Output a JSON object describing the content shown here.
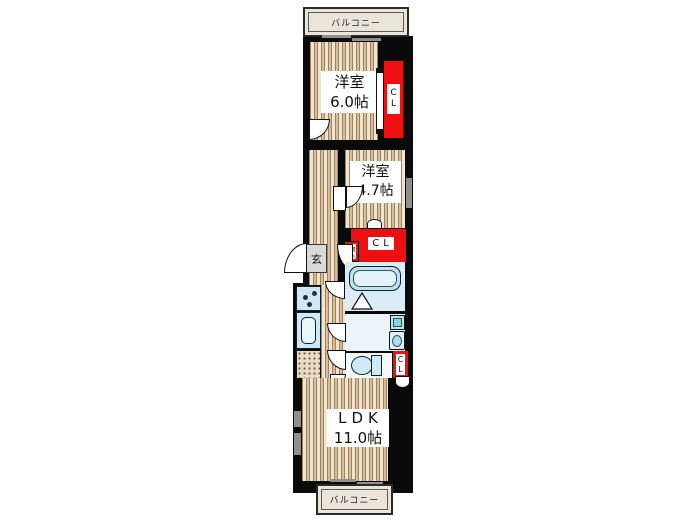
{
  "balconies": {
    "top": "バルコニー",
    "bottom": "バルコニー"
  },
  "rooms": {
    "room1": {
      "name": "洋室",
      "size": "6.0帖"
    },
    "room2": {
      "name": "洋室",
      "size": "4.7帖"
    },
    "ldk": {
      "name": "LDK",
      "size": "11.0帖"
    }
  },
  "labels": {
    "closet_room1": "CL",
    "closet_mid": "CL",
    "closet_toilet": "CL",
    "storage": "物入",
    "entrance": "玄"
  },
  "colors": {
    "wall": "#0a0a0a",
    "closet_red": "#ee1010",
    "fixture_blue": "#cfe9f4",
    "wood_light": "#f1e4cc",
    "wood_dark": "#dcbc97",
    "balcony_fill": "#e9e5d8",
    "window_gray": "#8f8f8f",
    "entrance_gray": "#d9d9d9"
  }
}
